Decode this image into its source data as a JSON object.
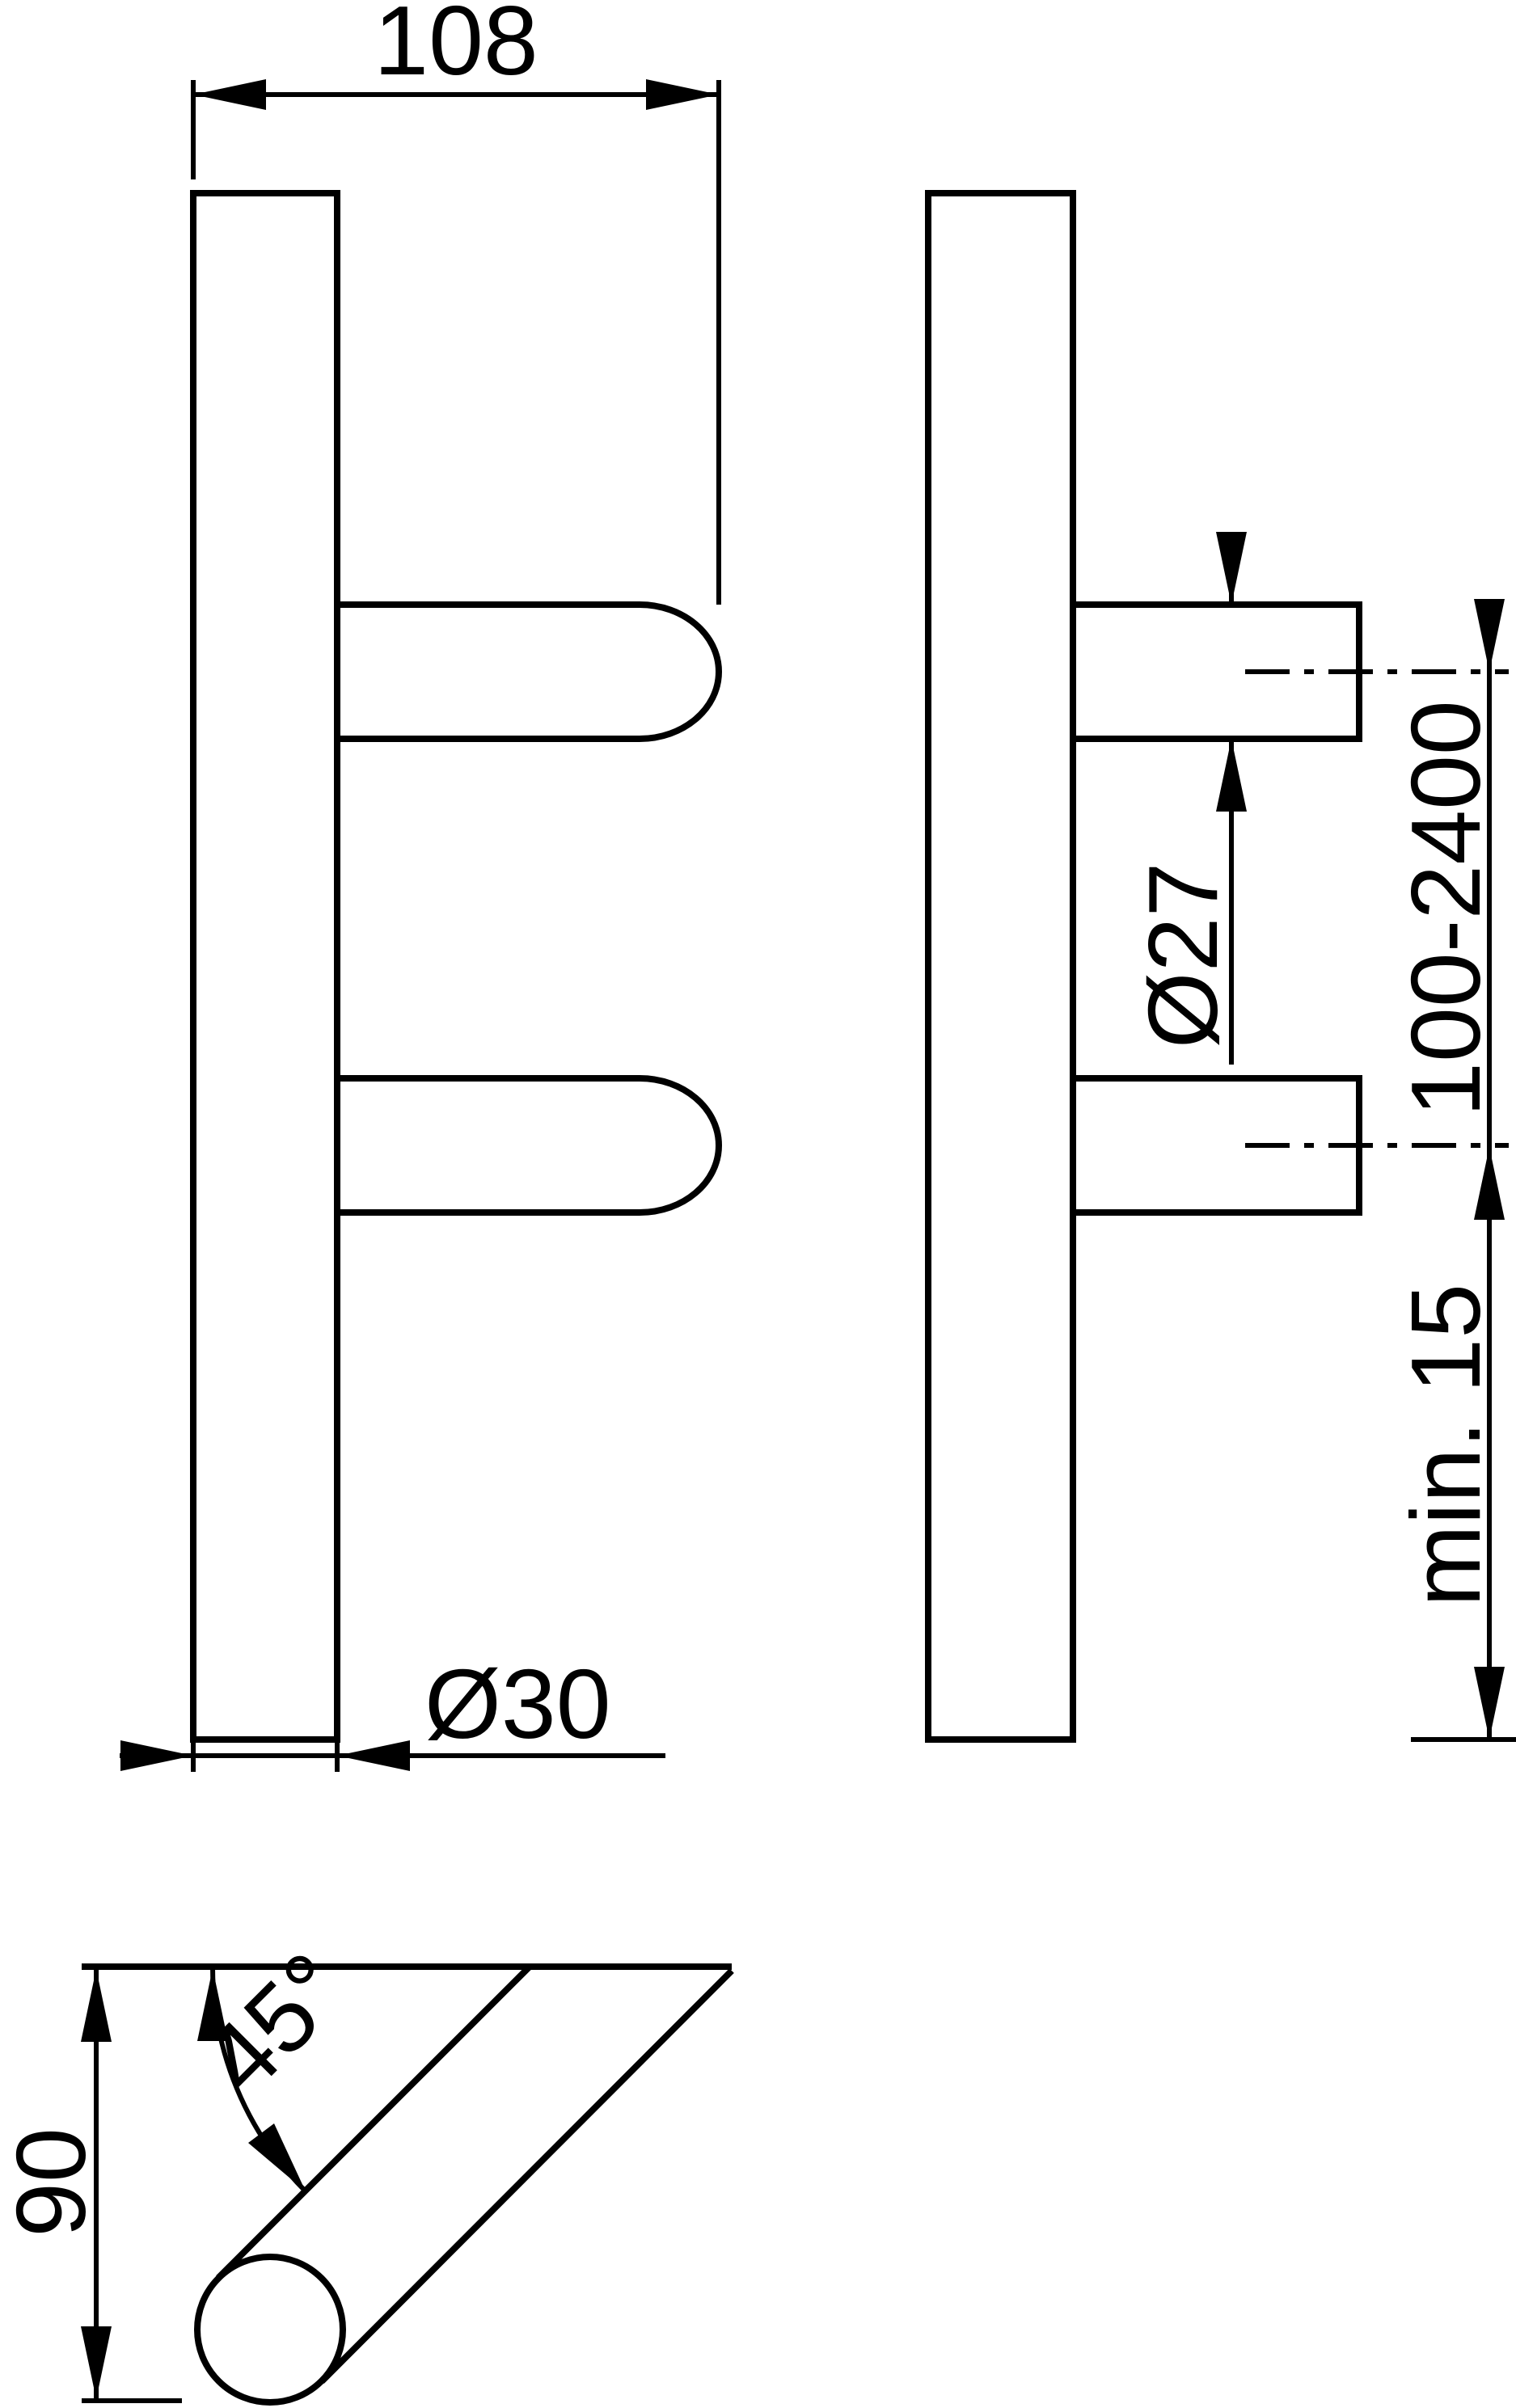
{
  "page": {
    "background": "#ffffff",
    "ink": "#000000"
  },
  "drawing": {
    "type": "technical-dimension-drawing",
    "views": {
      "front": "front view of pull handle with two supports",
      "side": "side view of pull handle with fixing supports",
      "angle_detail": "45-degree mounting angle cross-section"
    },
    "dimensions": {
      "projection_width": {
        "label": "108"
      },
      "grip_diameter": {
        "label": "Ø30"
      },
      "support_diameter": {
        "label": "Ø27"
      },
      "fixing_centers": {
        "label": "100-2400"
      },
      "min_end_distance": {
        "label": "min. 15"
      },
      "offset_height": {
        "label": "90"
      },
      "mounting_angle": {
        "label": "45°"
      }
    }
  }
}
